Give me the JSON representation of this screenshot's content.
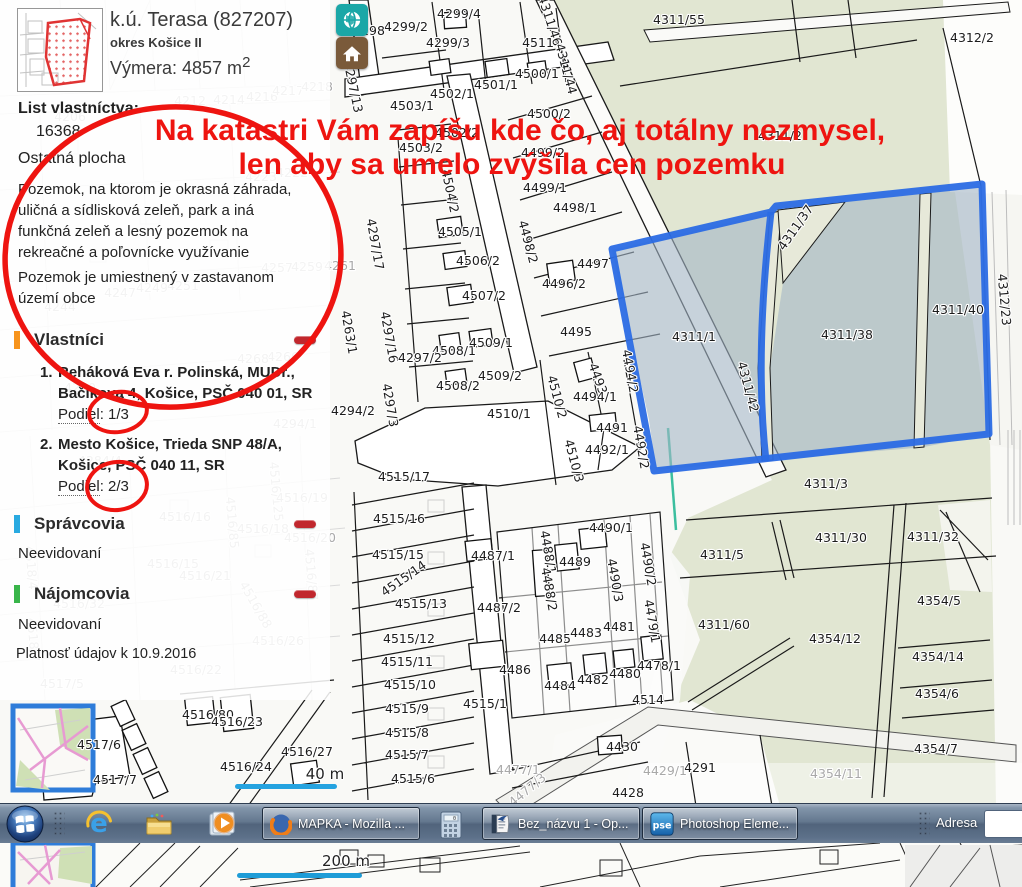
{
  "panel": {
    "header": {
      "title": "k.ú. Terasa (827207)",
      "district": "okres Košice II",
      "area_label": "Výmera: 4857 m",
      "area_sup": "2"
    },
    "lv_label": "List vlastníctva:",
    "lv_number": "16368",
    "plot_type": "Ostatná plocha",
    "desc1": "Pozemok, na ktorom je okrasná záhrada, uličná a sídlisková zeleň, park a iná funkčná zeleň a lesný pozemok na rekreačné a poľovnícke využívanie",
    "desc2": "Pozemok je umiestnený v zastavanom území obce",
    "owners": {
      "title": "Vlastníci",
      "items": [
        {
          "num": "1.",
          "line1": "Reháková Eva r. Polinská, MUDr.,",
          "line2": "Bačíkova 4, Košice, PSČ 040 01, SR",
          "podiel_label": "Podiel",
          "podiel_value": ": 1/3"
        },
        {
          "num": "2.",
          "line1": "Mesto Košice, Trieda SNP 48/A,",
          "line2": "Košice, PSČ 040 11, SR",
          "podiel_label": "Podiel",
          "podiel_value": ": 2/3"
        }
      ]
    },
    "managers": {
      "title": "Správcovia",
      "empty": "Neevidovaní"
    },
    "tenants": {
      "title": "Nájomcovia",
      "empty": "Neevidovaní"
    },
    "validity": "Platnosť údajov k 10.9.2016",
    "accent_owners": "#f7941d",
    "accent_managers": "#29aae1",
    "accent_tenants": "#39b54a",
    "minus_color": "#c1272d"
  },
  "annotation": {
    "line1": "Na katastri Vám zapíšu kde čo, aj totálny nezmysel,",
    "line2": "len aby sa umelo zvýšila cen pozemku",
    "color": "#ee1410"
  },
  "highlight": {
    "border_color": "#2b6be4",
    "fill_color": "#a3b6c6"
  },
  "taskbar": {
    "windows": [
      {
        "label": "MAPKA - Mozilla ..."
      },
      {
        "label": "Bez_názvu 1 - Op..."
      },
      {
        "label": "Photoshop Eleme..."
      }
    ],
    "pse_icon_text": "pse",
    "address_label": "Adresa"
  },
  "map": {
    "scale_small": "40 m",
    "scale_large": "200 m",
    "labels": [
      {
        "t": "4299/4",
        "x": 459,
        "y": 18
      },
      {
        "t": "4299/3",
        "x": 448,
        "y": 47
      },
      {
        "t": "4299/2",
        "x": 406,
        "y": 31
      },
      {
        "t": "4298",
        "x": 369,
        "y": 35
      },
      {
        "t": "4297/13",
        "x": 349,
        "y": 88,
        "r": 78
      },
      {
        "t": "4311/46",
        "x": 546,
        "y": 22,
        "r": 72
      },
      {
        "t": "4511",
        "x": 538,
        "y": 47
      },
      {
        "t": "4311/44",
        "x": 562,
        "y": 70,
        "r": 75
      },
      {
        "t": "4500/1",
        "x": 537,
        "y": 78
      },
      {
        "t": "4501/1",
        "x": 496,
        "y": 89
      },
      {
        "t": "4502/1",
        "x": 452,
        "y": 98
      },
      {
        "t": "4503/1",
        "x": 412,
        "y": 110
      },
      {
        "t": "4500/2",
        "x": 549,
        "y": 118
      },
      {
        "t": "4502/2",
        "x": 457,
        "y": 137
      },
      {
        "t": "4503/2",
        "x": 421,
        "y": 152
      },
      {
        "t": "4499/2",
        "x": 543,
        "y": 157
      },
      {
        "t": "4504/2",
        "x": 446,
        "y": 192,
        "r": 78
      },
      {
        "t": "4499/1",
        "x": 545,
        "y": 192
      },
      {
        "t": "4498/1",
        "x": 575,
        "y": 212
      },
      {
        "t": "4311/42",
        "x": 744,
        "y": 388,
        "r": 75
      },
      {
        "t": "4297/17",
        "x": 371,
        "y": 245,
        "r": 80
      },
      {
        "t": "4505/1",
        "x": 460,
        "y": 236
      },
      {
        "t": "4498/2",
        "x": 524,
        "y": 243,
        "r": 75
      },
      {
        "t": "4506/2",
        "x": 478,
        "y": 265
      },
      {
        "t": "4497",
        "x": 593,
        "y": 268
      },
      {
        "t": "4496/2",
        "x": 564,
        "y": 288
      },
      {
        "t": "4507/2",
        "x": 484,
        "y": 300
      },
      {
        "t": "4297/16",
        "x": 385,
        "y": 338,
        "r": 80
      },
      {
        "t": "4495",
        "x": 576,
        "y": 336
      },
      {
        "t": "4508/1",
        "x": 454,
        "y": 355
      },
      {
        "t": "4509/1",
        "x": 491,
        "y": 347
      },
      {
        "t": "4297/2",
        "x": 420,
        "y": 362
      },
      {
        "t": "4493",
        "x": 594,
        "y": 380,
        "r": 70
      },
      {
        "t": "4494/2",
        "x": 626,
        "y": 372,
        "r": 80
      },
      {
        "t": "4494/1",
        "x": 595,
        "y": 401
      },
      {
        "t": "4508/2",
        "x": 458,
        "y": 390
      },
      {
        "t": "4509/2",
        "x": 500,
        "y": 380
      },
      {
        "t": "4297/3",
        "x": 386,
        "y": 406,
        "r": 80
      },
      {
        "t": "4510/2",
        "x": 553,
        "y": 398,
        "r": 75
      },
      {
        "t": "4510/1",
        "x": 509,
        "y": 418
      },
      {
        "t": "4294/2",
        "x": 353,
        "y": 415
      },
      {
        "t": "4263/1",
        "x": 345,
        "y": 333,
        "r": 80
      },
      {
        "t": "4491",
        "x": 612,
        "y": 432
      },
      {
        "t": "4492/1",
        "x": 607,
        "y": 454
      },
      {
        "t": "4492/2",
        "x": 637,
        "y": 448,
        "r": 80
      },
      {
        "t": "4510/3",
        "x": 570,
        "y": 462,
        "r": 75
      },
      {
        "t": "4515/17",
        "x": 404,
        "y": 481
      },
      {
        "t": "4515/16",
        "x": 399,
        "y": 523
      },
      {
        "t": "4515/15",
        "x": 398,
        "y": 559
      },
      {
        "t": "4515/14",
        "x": 406,
        "y": 582,
        "r": -35
      },
      {
        "t": "4515/13",
        "x": 421,
        "y": 608
      },
      {
        "t": "4515/12",
        "x": 409,
        "y": 643
      },
      {
        "t": "4515/11",
        "x": 407,
        "y": 666
      },
      {
        "t": "4515/10",
        "x": 410,
        "y": 689
      },
      {
        "t": "4515/9",
        "x": 407,
        "y": 713
      },
      {
        "t": "4515/8",
        "x": 407,
        "y": 737
      },
      {
        "t": "4515/7",
        "x": 407,
        "y": 759
      },
      {
        "t": "4515/6",
        "x": 413,
        "y": 783
      },
      {
        "t": "4487/1",
        "x": 493,
        "y": 560
      },
      {
        "t": "4487/2",
        "x": 499,
        "y": 612
      },
      {
        "t": "4488/1",
        "x": 544,
        "y": 553,
        "r": 80
      },
      {
        "t": "4488/2",
        "x": 545,
        "y": 590,
        "r": 80
      },
      {
        "t": "4489",
        "x": 575,
        "y": 566
      },
      {
        "t": "4490/1",
        "x": 611,
        "y": 532
      },
      {
        "t": "4490/3",
        "x": 611,
        "y": 581,
        "r": 80
      },
      {
        "t": "4490/2",
        "x": 644,
        "y": 565,
        "r": 80
      },
      {
        "t": "4479/1",
        "x": 648,
        "y": 622,
        "r": 80
      },
      {
        "t": "4481",
        "x": 619,
        "y": 631
      },
      {
        "t": "4483",
        "x": 586,
        "y": 637
      },
      {
        "t": "4485",
        "x": 555,
        "y": 643
      },
      {
        "t": "4486",
        "x": 515,
        "y": 674
      },
      {
        "t": "4484",
        "x": 560,
        "y": 690
      },
      {
        "t": "4482",
        "x": 593,
        "y": 684
      },
      {
        "t": "4480",
        "x": 625,
        "y": 678
      },
      {
        "t": "4478/1",
        "x": 659,
        "y": 670
      },
      {
        "t": "4515/1",
        "x": 485,
        "y": 708
      },
      {
        "t": "4514",
        "x": 648,
        "y": 704
      },
      {
        "t": "4430",
        "x": 622,
        "y": 751
      },
      {
        "t": "4428",
        "x": 628,
        "y": 797
      },
      {
        "t": "4291",
        "x": 700,
        "y": 772
      },
      {
        "t": "4311/1",
        "x": 694,
        "y": 341
      },
      {
        "t": "4311/38",
        "x": 847,
        "y": 339
      },
      {
        "t": "4311/40",
        "x": 958,
        "y": 314
      },
      {
        "t": "4311/37",
        "x": 799,
        "y": 230,
        "r": -55
      },
      {
        "t": "4312/23",
        "x": 1000,
        "y": 300,
        "r": 85
      },
      {
        "t": "4311/2",
        "x": 780,
        "y": 140
      },
      {
        "t": "4311/55",
        "x": 679,
        "y": 24
      },
      {
        "t": "4312/2",
        "x": 972,
        "y": 42
      },
      {
        "t": "4311/3",
        "x": 826,
        "y": 488
      },
      {
        "t": "4311/30",
        "x": 841,
        "y": 542
      },
      {
        "t": "4311/32",
        "x": 933,
        "y": 541
      },
      {
        "t": "4311/5",
        "x": 722,
        "y": 559
      },
      {
        "t": "4311/60",
        "x": 724,
        "y": 629
      },
      {
        "t": "4354/12",
        "x": 835,
        "y": 643
      },
      {
        "t": "4354/5",
        "x": 939,
        "y": 605
      },
      {
        "t": "4354/14",
        "x": 938,
        "y": 661
      },
      {
        "t": "4354/6",
        "x": 937,
        "y": 698
      },
      {
        "t": "4354/7",
        "x": 936,
        "y": 753
      },
      {
        "t": "4516/80",
        "x": 208,
        "y": 719
      },
      {
        "t": "4516/23",
        "x": 237,
        "y": 726
      },
      {
        "t": "4517/6",
        "x": 99,
        "y": 749
      },
      {
        "t": "4516/27",
        "x": 307,
        "y": 756
      },
      {
        "t": "4516/24",
        "x": 246,
        "y": 771
      },
      {
        "t": "4517/7",
        "x": 115,
        "y": 784
      },
      {
        "t": "4477/1",
        "x": 518,
        "y": 774,
        "c": "g"
      },
      {
        "t": "4477/3",
        "x": 530,
        "y": 793,
        "r": -40,
        "c": "g"
      },
      {
        "t": "4429/1",
        "x": 665,
        "y": 775,
        "c": "g"
      },
      {
        "t": "4354/11",
        "x": 836,
        "y": 778,
        "c": "g"
      },
      {
        "t": "4212",
        "x": 190,
        "y": 105,
        "c": "g"
      },
      {
        "t": "4214",
        "x": 229,
        "y": 104,
        "c": "g"
      },
      {
        "t": "4216",
        "x": 262,
        "y": 101,
        "c": "g"
      },
      {
        "t": "4217",
        "x": 288,
        "y": 95,
        "c": "g"
      },
      {
        "t": "4218",
        "x": 317,
        "y": 91,
        "c": "g"
      },
      {
        "t": "4206",
        "x": 70,
        "y": 121,
        "c": "g"
      },
      {
        "t": "4223",
        "x": 261,
        "y": 181,
        "c": "g"
      },
      {
        "t": "4222",
        "x": 292,
        "y": 177,
        "c": "g"
      },
      {
        "t": "4257",
        "x": 277,
        "y": 272,
        "c": "g"
      },
      {
        "t": "4259",
        "x": 307,
        "y": 271,
        "c": "g"
      },
      {
        "t": "4261",
        "x": 340,
        "y": 270,
        "c": "g"
      },
      {
        "t": "4247",
        "x": 120,
        "y": 297,
        "c": "g"
      },
      {
        "t": "4249",
        "x": 152,
        "y": 292,
        "c": "g"
      },
      {
        "t": "4251",
        "x": 183,
        "y": 290,
        "c": "g"
      },
      {
        "t": "4244",
        "x": 60,
        "y": 311,
        "c": "g"
      },
      {
        "t": "4266",
        "x": 283,
        "y": 361,
        "c": "g"
      },
      {
        "t": "4268",
        "x": 253,
        "y": 363,
        "c": "g"
      },
      {
        "t": "4280",
        "x": 80,
        "y": 392,
        "c": "g"
      },
      {
        "t": "4284/4",
        "x": 100,
        "y": 465,
        "c": "g"
      },
      {
        "t": "4294/1",
        "x": 295,
        "y": 428,
        "c": "g"
      },
      {
        "t": "4516/125",
        "x": 272,
        "y": 492,
        "r": 85,
        "c": "g"
      },
      {
        "t": "4516/19",
        "x": 302,
        "y": 502,
        "c": "g"
      },
      {
        "t": "4516/16",
        "x": 185,
        "y": 521,
        "c": "g"
      },
      {
        "t": "4516/85",
        "x": 228,
        "y": 523,
        "r": 85,
        "c": "g"
      },
      {
        "t": "4516/18",
        "x": 263,
        "y": 533,
        "c": "g"
      },
      {
        "t": "4516/20",
        "x": 310,
        "y": 542,
        "c": "g"
      },
      {
        "t": "4516/15",
        "x": 173,
        "y": 568,
        "c": "g"
      },
      {
        "t": "4516/21",
        "x": 205,
        "y": 580,
        "c": "g"
      },
      {
        "t": "4516/87",
        "x": 307,
        "y": 575,
        "r": 85,
        "c": "g"
      },
      {
        "t": "4516/88",
        "x": 252,
        "y": 607,
        "r": 60,
        "c": "g"
      },
      {
        "t": "4516/32",
        "x": 79,
        "y": 608,
        "c": "g"
      },
      {
        "t": "4516/26",
        "x": 278,
        "y": 645,
        "c": "g"
      },
      {
        "t": "4516/22",
        "x": 196,
        "y": 674,
        "c": "g"
      },
      {
        "t": "4518/7",
        "x": 29,
        "y": 640,
        "r": 85,
        "c": "g"
      },
      {
        "t": "4518/4",
        "x": 27,
        "y": 568,
        "r": 85,
        "c": "g"
      },
      {
        "t": "4517/5",
        "x": 62,
        "y": 688,
        "c": "g"
      },
      {
        "t": "40 m",
        "x": 325,
        "y": 779,
        "c": "d"
      },
      {
        "t": "200 m",
        "x": 346,
        "y": 866,
        "c": "d"
      }
    ]
  }
}
